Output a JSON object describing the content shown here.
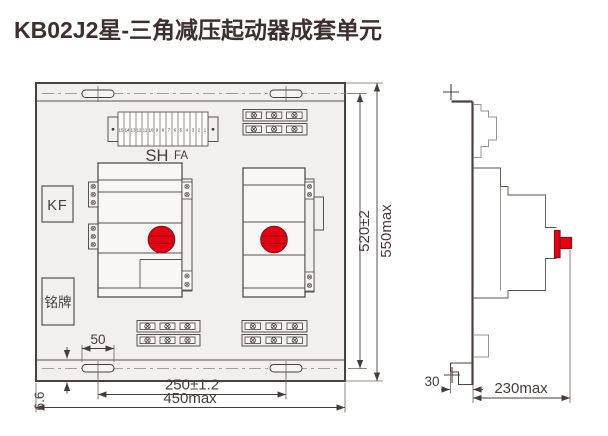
{
  "title": "KB02J2星-三角减压起动器成套单元",
  "colors": {
    "line": "#4a403e",
    "panel_fill": "#f1f0ee",
    "red": "#e60012",
    "title": "#3c302e"
  },
  "front_view": {
    "labels": {
      "kf": "KF",
      "nameplate": "铭牌",
      "sh": "SH",
      "fa": "FA"
    },
    "terminal_numbers": [
      "15",
      "14",
      "13",
      "12",
      "11",
      "10",
      "9",
      "8",
      "7",
      "6",
      "5",
      "4",
      "3",
      "2",
      "1"
    ],
    "dimensions": {
      "slot_width": "50",
      "edge_offset": "6.6",
      "hole_pitch_h": "250±1.2",
      "width_max": "450max",
      "hole_pitch_v": "520±2",
      "height_max": "550max"
    }
  },
  "side_view": {
    "dimensions": {
      "foot_depth": "30",
      "depth_max": "230max"
    }
  }
}
